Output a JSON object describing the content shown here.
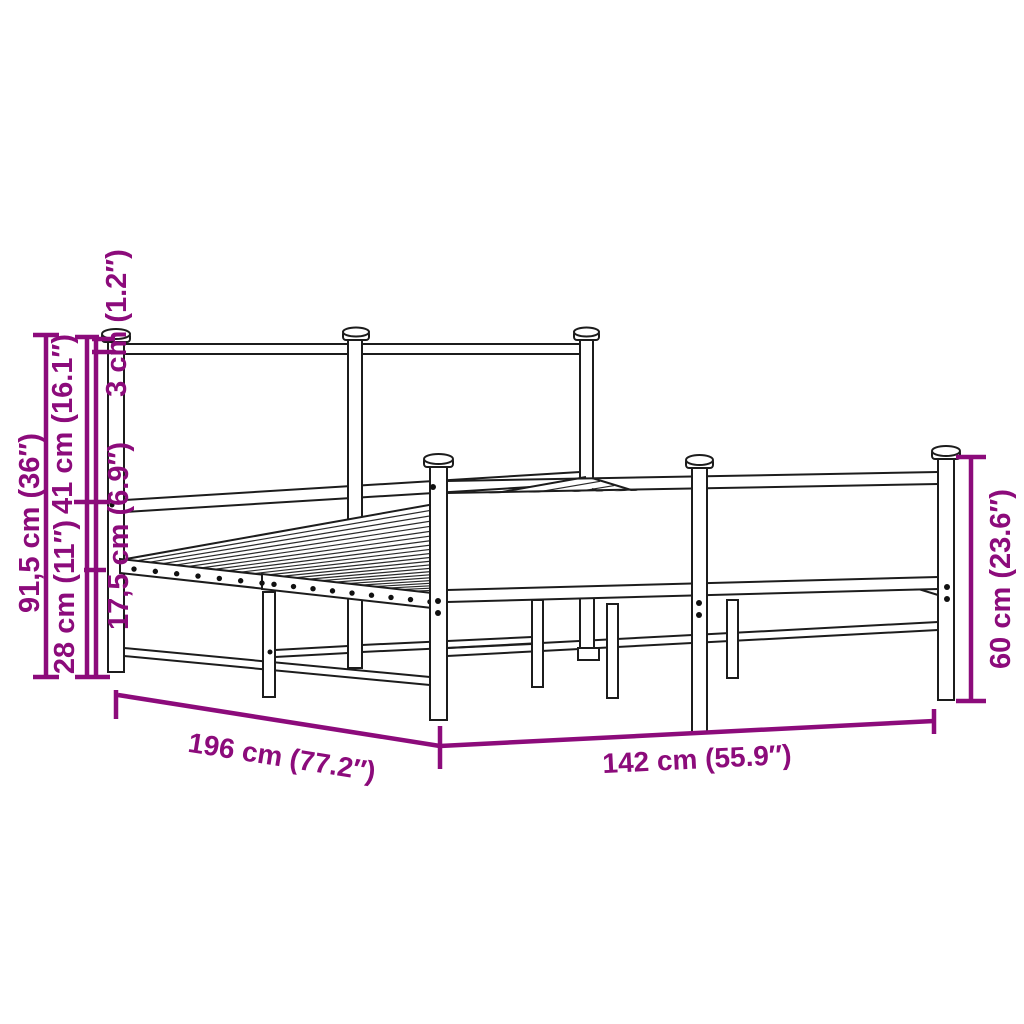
{
  "diagram": {
    "title": "Metal bed frame dimension diagram",
    "background_color": "#ffffff",
    "outline_color": "#1c1c1c",
    "accent_color": "#8C0B7B",
    "labels": {
      "overall_height": "91,5 cm (36″)",
      "headboard_top_rail": "3 cm (1.2″)",
      "headboard_panel": "41 cm (16.1″)",
      "frame_depth": "17,5 cm (6.9″)",
      "ground_clearance": "28 cm (11″)",
      "length": "196 cm (77.2″)",
      "width": "142 cm (55.9″)",
      "footboard_height": "60 cm (23.6″)"
    }
  }
}
